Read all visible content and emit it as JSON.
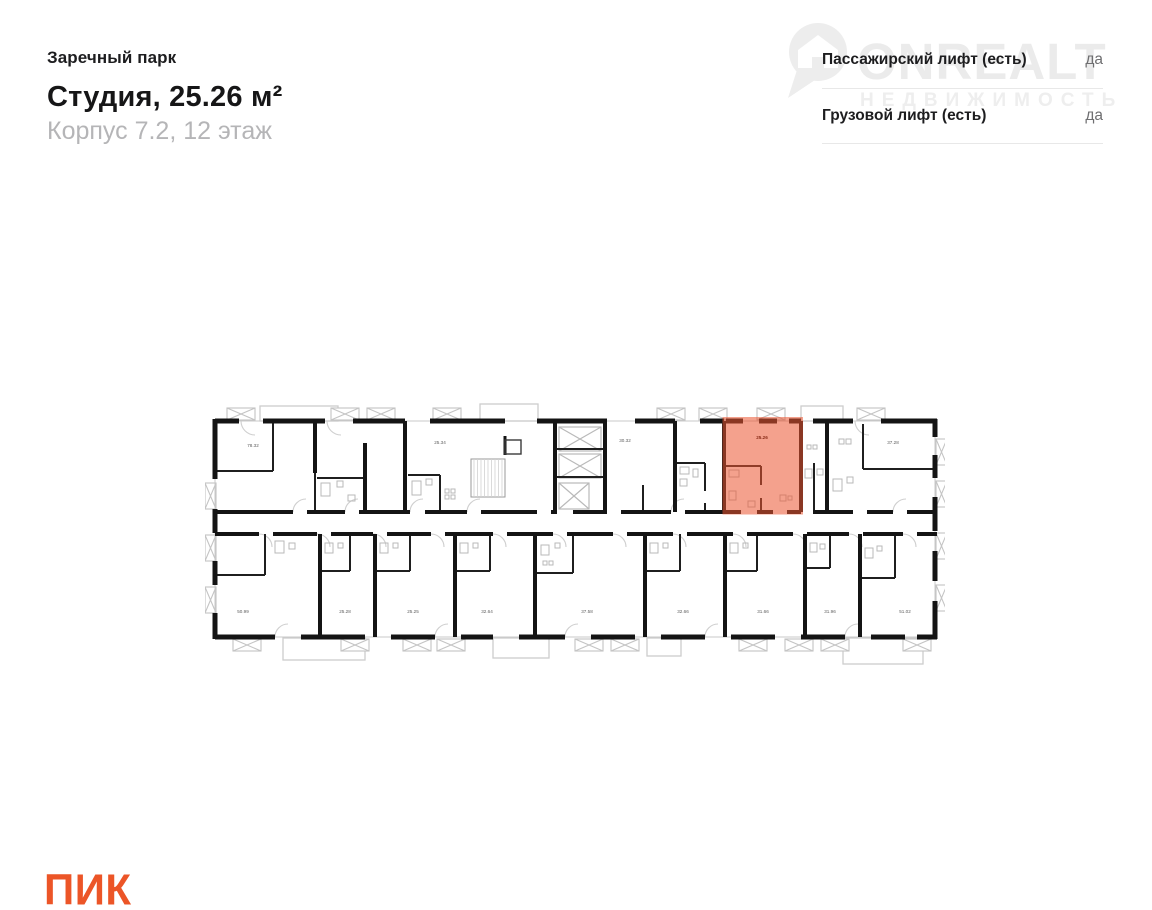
{
  "header": {
    "project": "Заречный парк",
    "title": "Студия, 25.26 м²",
    "subtitle": "Корпус 7.2, 12 этаж"
  },
  "info_panel": {
    "rows": [
      {
        "label": "Пассажирский лифт (есть)",
        "value": "да"
      },
      {
        "label": "Грузовой лифт (есть)",
        "value": "да"
      }
    ]
  },
  "watermark": {
    "brand": "ONREALT",
    "subtext": "НЕДВИЖИМОСТЬ"
  },
  "plan": {
    "highlight": {
      "area": "25.26",
      "fill": "#ef5430",
      "label_color": "#8a2c18"
    },
    "rooms_top": [
      "78.32",
      "25.34",
      "30.32",
      "37.28"
    ],
    "rooms_bottom": [
      "50.99",
      "25.28",
      "25.25",
      "32.64",
      "37.58",
      "32.66",
      "31.66",
      "31.96",
      "51.02"
    ]
  },
  "footer": {
    "logo": "ПИК",
    "logo_color": "#ec5527"
  }
}
